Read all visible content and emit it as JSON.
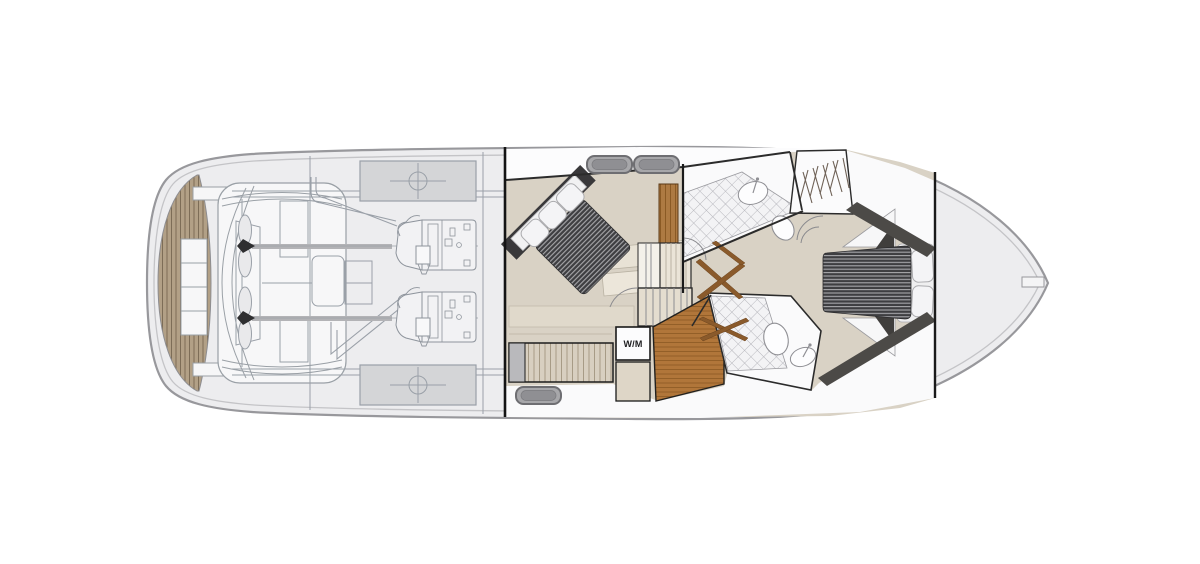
{
  "figure": {
    "kind": "yacht-lower-deck-floor-plan",
    "orientation": "bow-right"
  },
  "labels": {
    "washing_machine": "W/M"
  },
  "palette": {
    "page_bg": "#ffffff",
    "hull_fill": "#ededef",
    "hull_line": "#98989c",
    "hull_inner_line": "#c4c4c7",
    "wall_black": "#1a1a1a",
    "wall_gray": "#2b2b2b",
    "floor_beige": "#d9d2c5",
    "floor_beige_light": "#e8e2d5",
    "white_room": "#fafafb",
    "teak": "#b2a086",
    "teak_line": "#7d6d57",
    "wood": "#ad7a42",
    "wood_line": "#8a5a24",
    "wood_floor": "#b1763a",
    "louver": "#d8cfc0",
    "mattress_dark": "#3e3e41",
    "mattress_stripe": "#a9a9ac",
    "pillow": "#f4f4f6",
    "dark_furniture": "#4c4a47",
    "dark_headboard": "#39383a",
    "tile_bg": "#f3f3f5",
    "tile_line": "#b4b4ba",
    "hatch_fill": "#a7a7aa",
    "hatch_inner": "#8f8f93",
    "hatch_border": "#6e6e72",
    "engine_line": "#9aa0a8",
    "tank_fill": "#d4d5d7",
    "shaft_gray": "#b3b3b6",
    "door_wood": "#8a5a2b"
  },
  "components": [
    "swim-platform-teak",
    "transom-seat",
    "transom-steps",
    "engine-room",
    "port-engine",
    "starboard-engine",
    "port-propeller",
    "starboard-propeller",
    "fuel-tank-top",
    "fuel-tank-bottom",
    "aft-bulkhead",
    "mid-cabin",
    "mid-cabin-double-bed",
    "louvered-wardrobe",
    "staircase",
    "washing-machine",
    "upper-bathroom",
    "lower-bathroom",
    "toilet",
    "wash-basin",
    "hanging-locker",
    "corridor-doors",
    "wood-floor",
    "fore-cabin",
    "fore-cabin-double-bed",
    "wardrobe-bands",
    "fore-bulkhead",
    "forepeak",
    "bow-fitting",
    "deck-hatches"
  ]
}
